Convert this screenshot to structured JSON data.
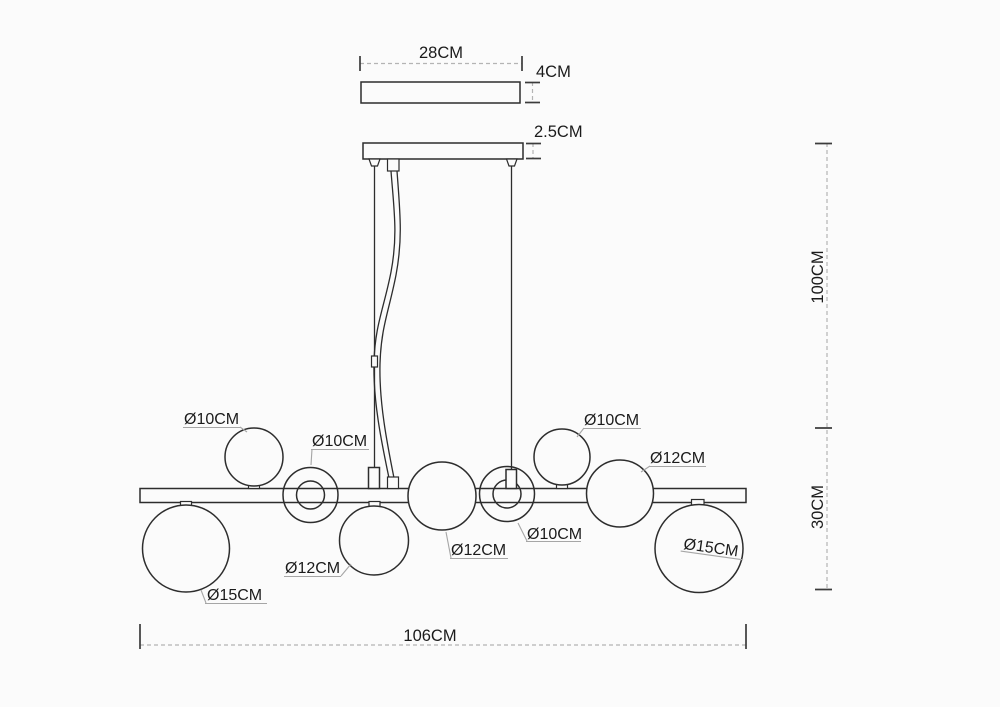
{
  "drawing": {
    "type": "technical-dimension-diagram",
    "subject": "linear pendant chandelier with glass globes",
    "background_color": "#fbfbfb",
    "line_color": "#2d2d2d",
    "dimension_line_color": "#b4b4b4",
    "text_color": "#1b1b1b",
    "dims": {
      "canopy_width": "28CM",
      "canopy_height": "4CM",
      "plate_height": "2.5CM",
      "drop_height": "100CM",
      "fixture_height": "30CM",
      "bar_length": "106CM"
    },
    "globes": [
      {
        "text": "Ø10CM",
        "position": "above-bar-left"
      },
      {
        "text": "Ø10CM",
        "position": "on-bar-ring-left"
      },
      {
        "text": "Ø10CM",
        "position": "above-bar-right"
      },
      {
        "text": "Ø10CM",
        "position": "on-bar-ring-right"
      },
      {
        "text": "Ø12CM",
        "position": "below-bar-mid-left"
      },
      {
        "text": "Ø12CM",
        "position": "on-bar-center"
      },
      {
        "text": "Ø12CM",
        "position": "on-bar-right"
      },
      {
        "text": "Ø15CM",
        "position": "below-bar-far-left"
      },
      {
        "text": "Ø15CM",
        "position": "below-bar-far-right"
      }
    ]
  }
}
